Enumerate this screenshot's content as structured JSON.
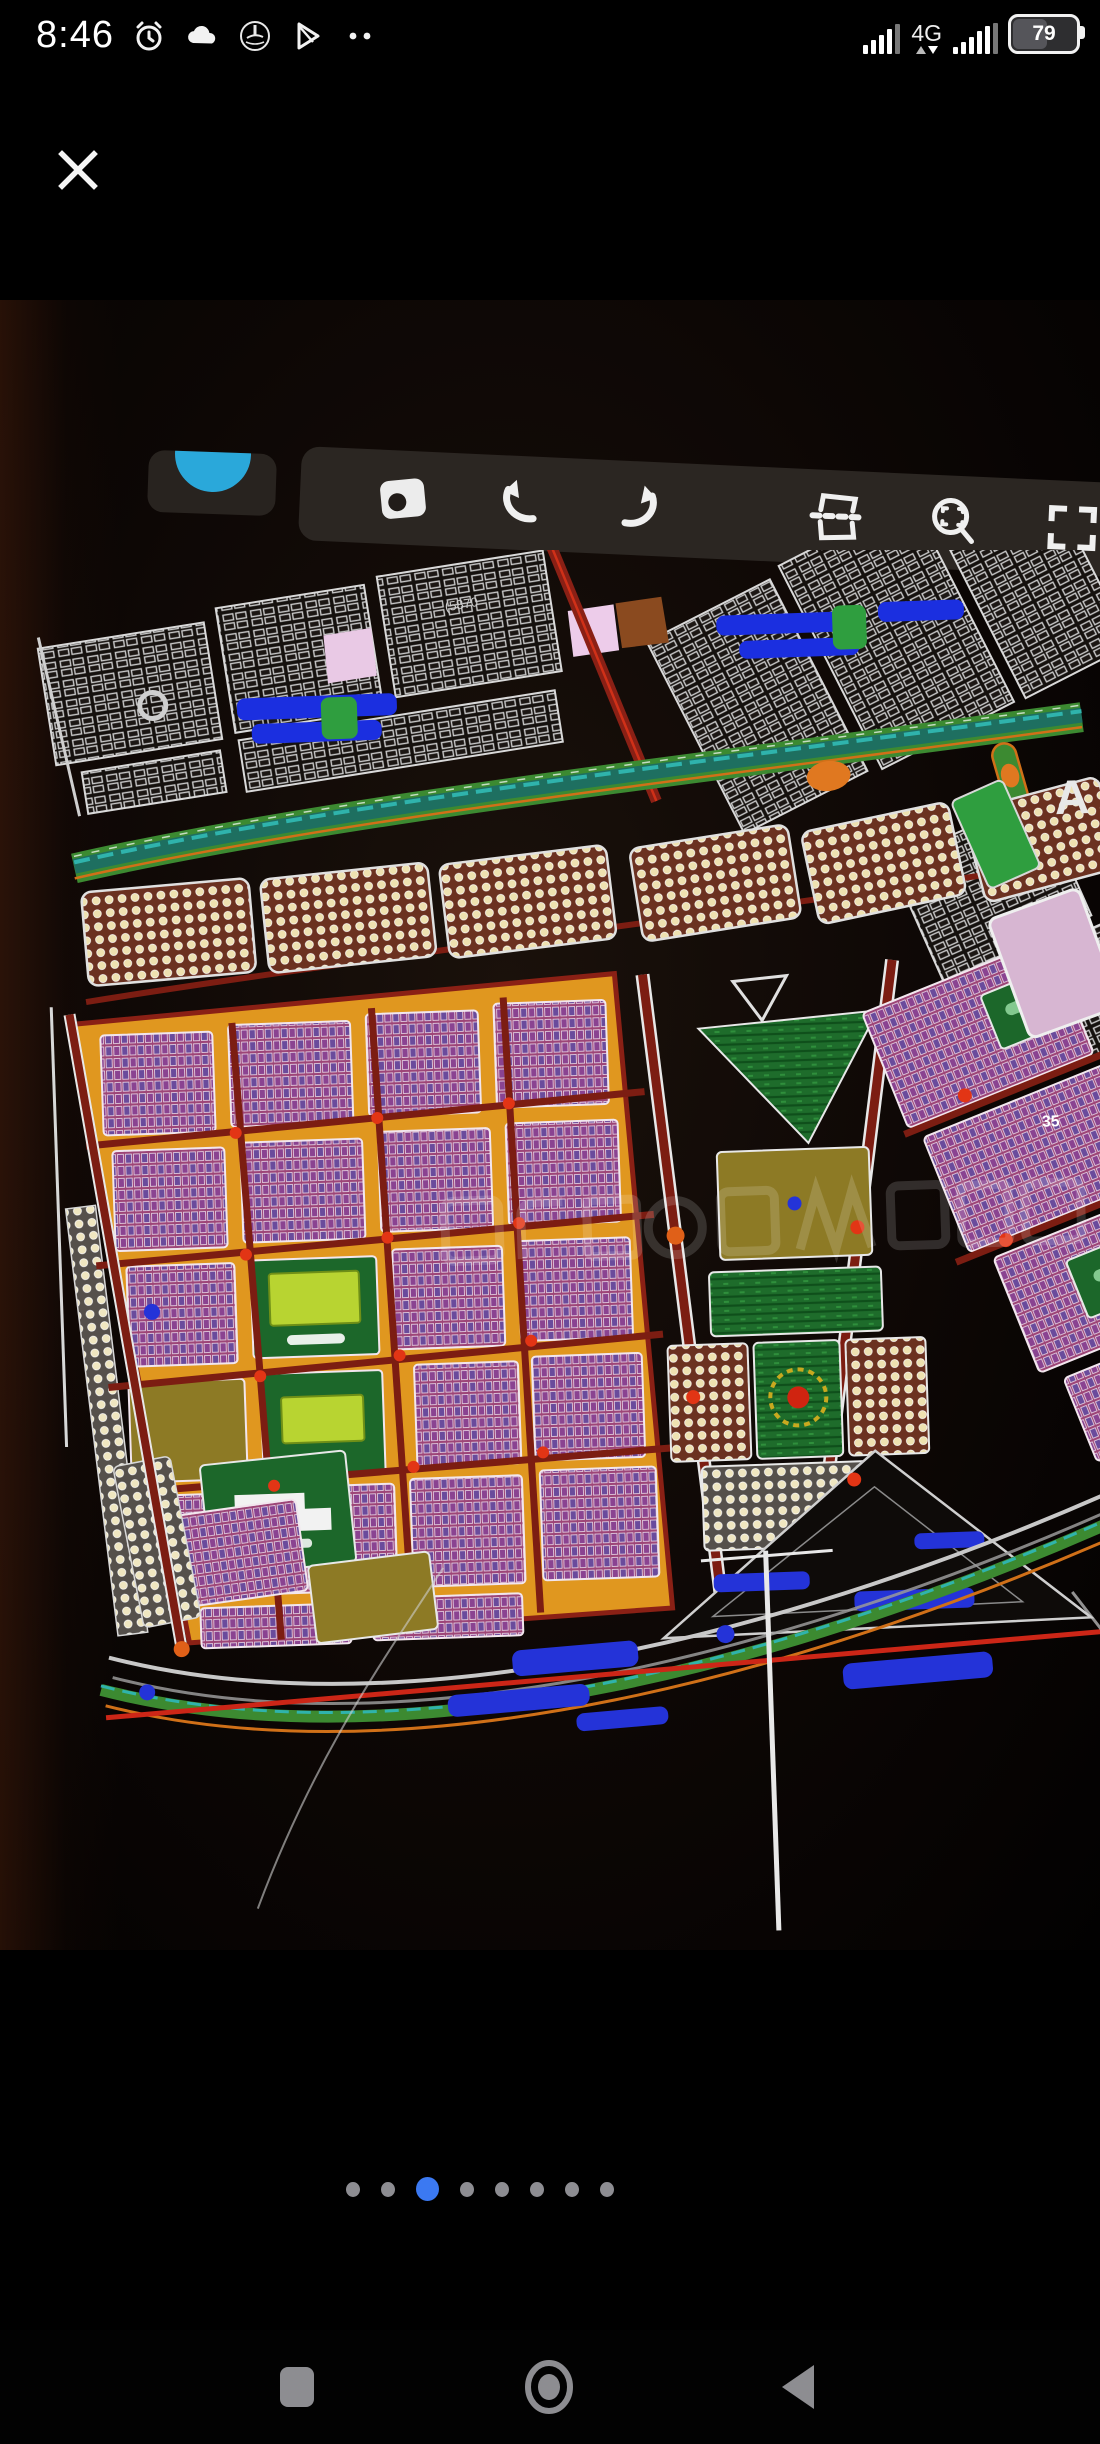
{
  "status_bar": {
    "time": "8:46",
    "network": "4G",
    "battery_percent": "79",
    "left_icons": [
      "alarm-icon",
      "cloud-icon",
      "app-badge-icon",
      "play-store-icon",
      "more-notifications-dots"
    ],
    "right_icons": [
      "signal-sim1",
      "signal-sim2",
      "battery"
    ]
  },
  "viewer": {
    "photo_description": "Photo of a screen showing a colorful CAD master plan of a city subdivision",
    "accent_blue": "#3b79f2",
    "toolbar_bg": "#2b2622"
  },
  "photo_toolbar": {
    "buttons": [
      "camera",
      "undo",
      "redo",
      "section",
      "zoom-extents",
      "fullscreen"
    ]
  },
  "map_annotations": {
    "area_label": "(5870",
    "road_label": "35",
    "corner_letter": "A"
  },
  "pager": {
    "count": 8,
    "active_index": 2
  },
  "nav_bar": {
    "buttons": [
      "recents",
      "home",
      "back"
    ]
  }
}
